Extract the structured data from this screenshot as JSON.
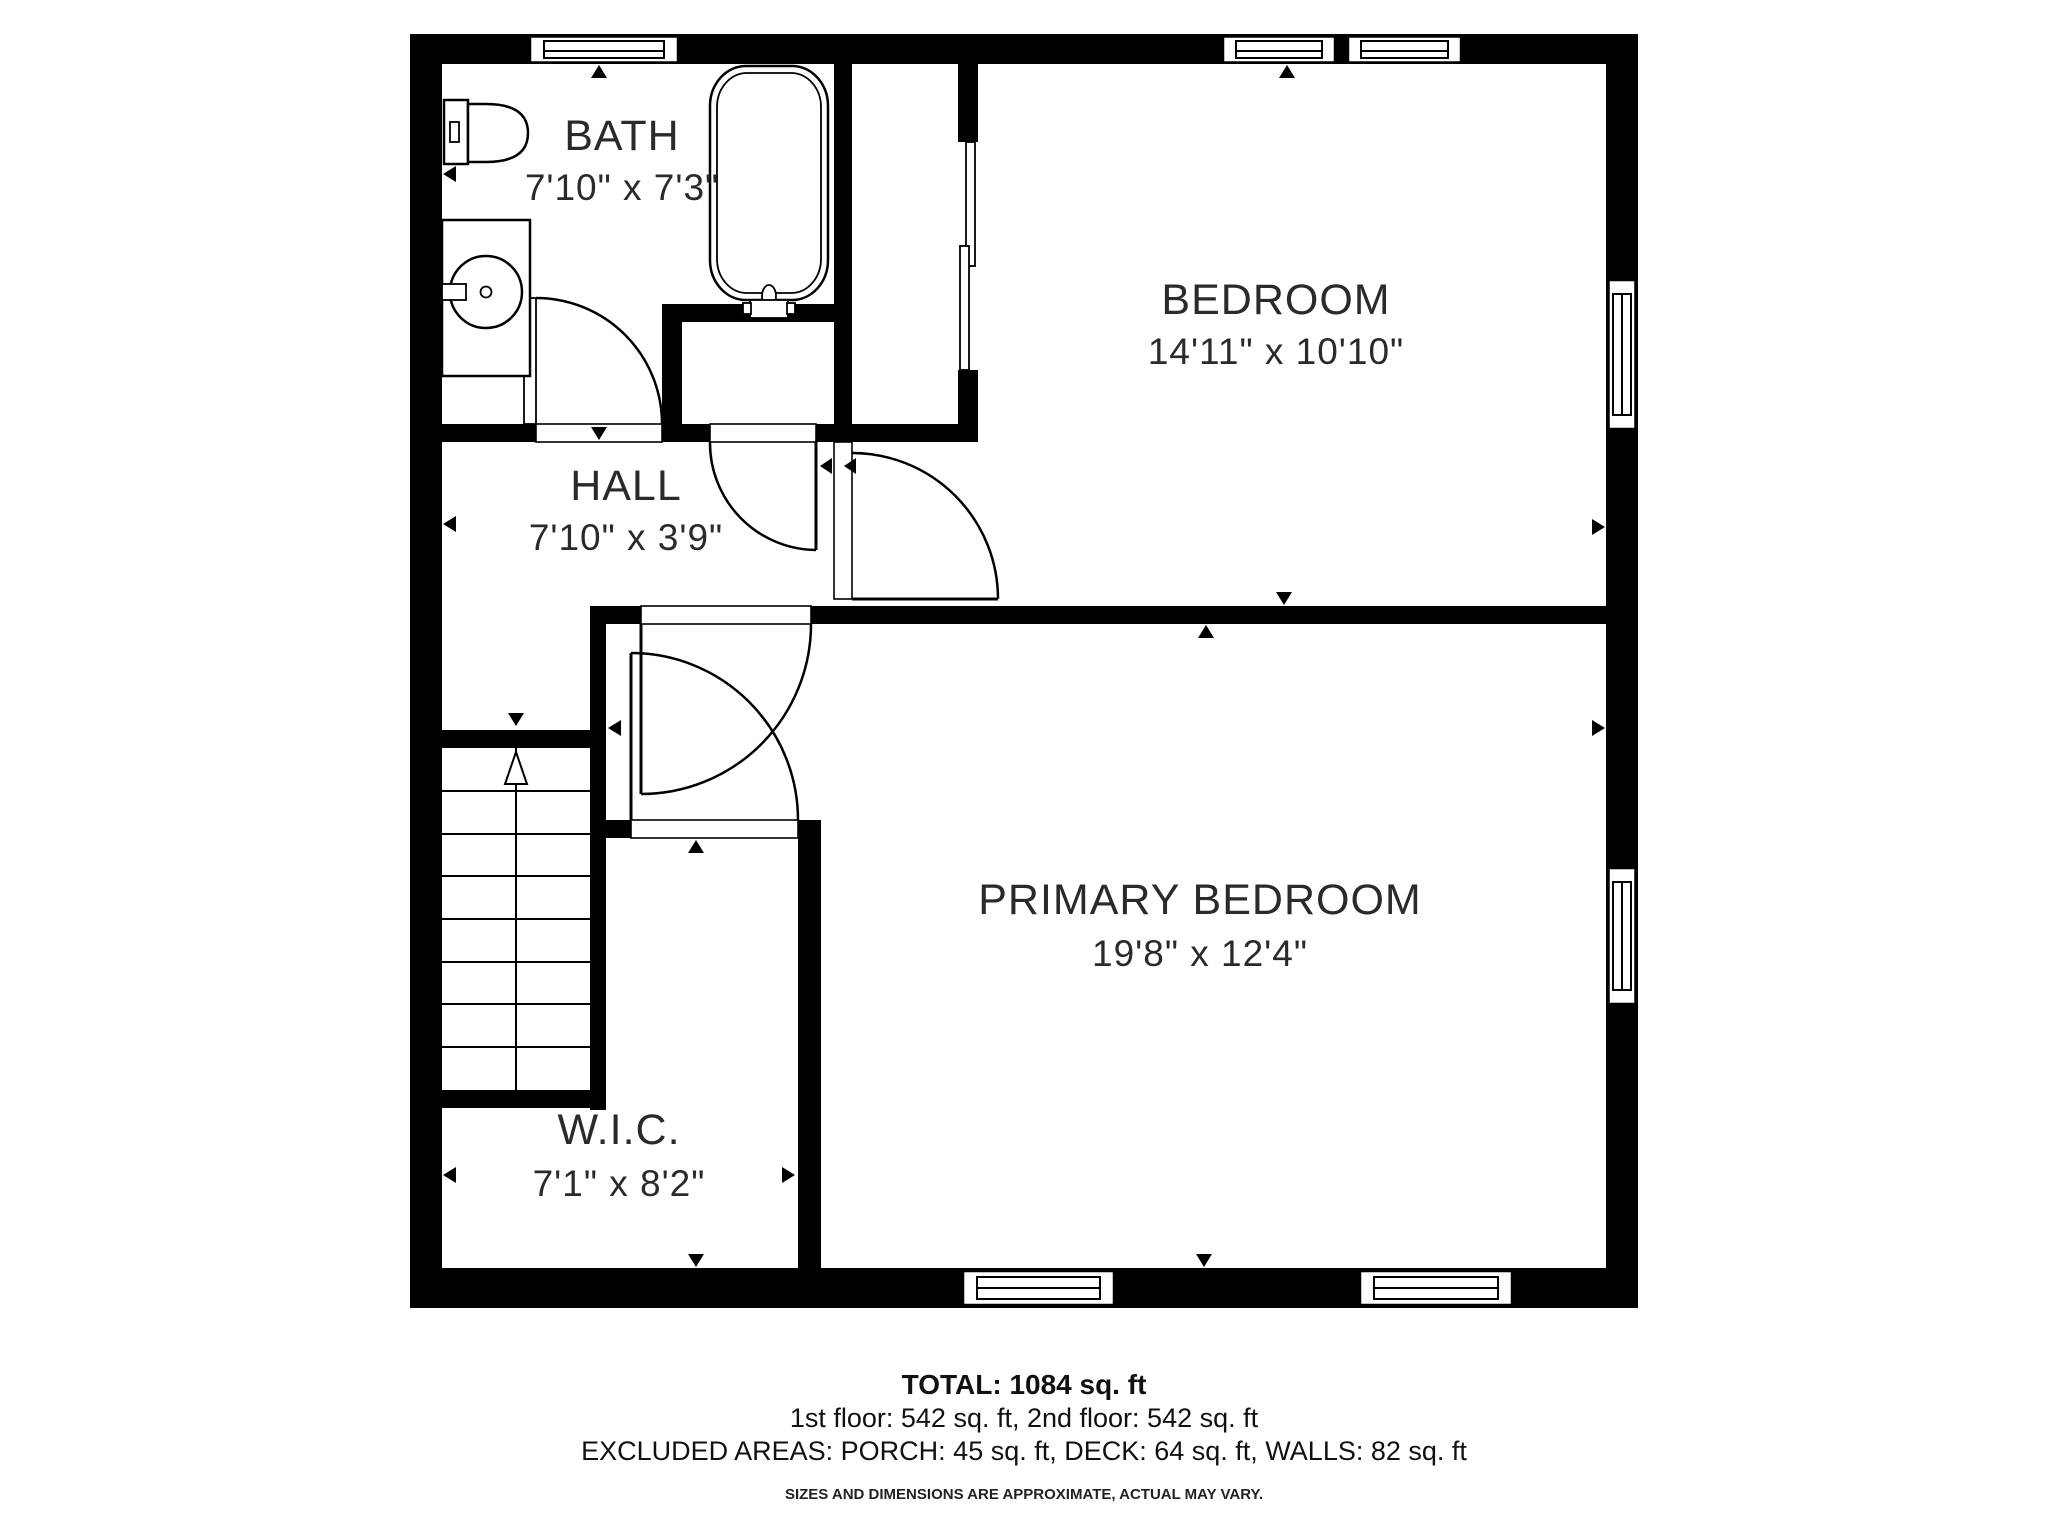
{
  "title": "Second floor plan",
  "rooms": [
    {
      "name": "BATH",
      "dims": "7'10\" x 7'3\""
    },
    {
      "name": "HALL",
      "dims": "7'10\" x 3'9\""
    },
    {
      "name": "BEDROOM",
      "dims": "14'11\" x 10'10\""
    },
    {
      "name": "PRIMARY BEDROOM",
      "dims": "19'8\" x 12'4\""
    },
    {
      "name": "W.I.C.",
      "dims": "7'1\" x 8'2\""
    }
  ],
  "fixtures": [
    "toilet",
    "sink-vanity",
    "bathtub",
    "stairs-up"
  ],
  "footer": {
    "total": "TOTAL: 1084 sq. ft",
    "floors": "1st floor: 542 sq. ft, 2nd floor: 542 sq. ft",
    "excluded": "EXCLUDED AREAS: PORCH: 45 sq. ft, DECK: 64 sq. ft, WALLS: 82 sq. ft",
    "disclaimer": "SIZES AND DIMENSIONS ARE APPROXIMATE, ACTUAL MAY VARY."
  },
  "colors": {
    "wall": "#000000",
    "background": "#ffffff",
    "label": "#2a2a2a"
  }
}
